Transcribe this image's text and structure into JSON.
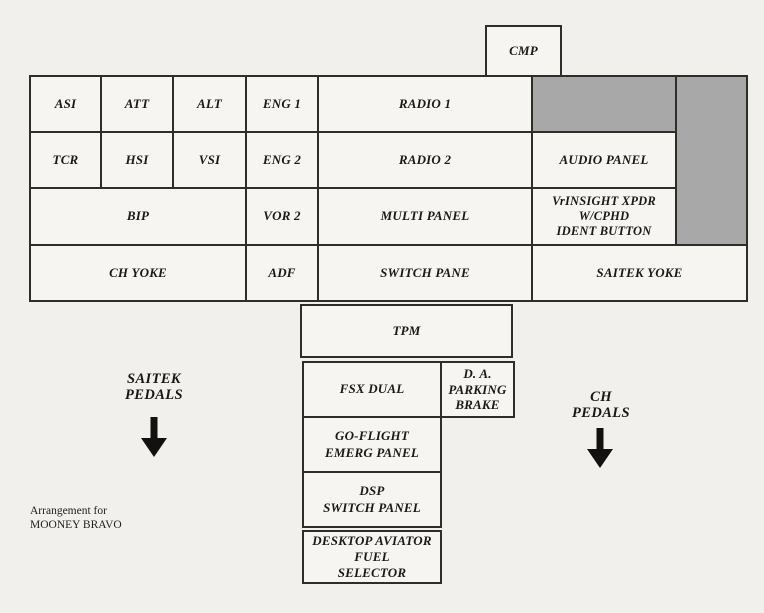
{
  "title_note": "Arrangement for\nMOONEY BRAVO",
  "colors": {
    "paper": "#f1f0ed",
    "cell_fill": "#f6f5f2",
    "gray_fill": "#a8a8a8",
    "border": "#2e2d2b"
  },
  "cmp_box": {
    "label": "CMP"
  },
  "panel_grid": {
    "row1": {
      "asi": "ASI",
      "att": "ATT",
      "alt": "ALT",
      "eng1": "ENG 1",
      "radio1": "RADIO 1"
    },
    "row2": {
      "tcr": "TCR",
      "hsi": "HSI",
      "vsi": "VSI",
      "eng2": "ENG 2",
      "radio2": "RADIO 2",
      "audio_panel": "AUDIO PANEL"
    },
    "row3": {
      "bip": "BIP",
      "vor2": "VOR 2",
      "multi_panel": "MULTI PANEL",
      "vrinsight_xpdr": "VrINSIGHT XPDR\nW/CPHD\nIDENT BUTTON"
    },
    "row4": {
      "ch_yoke": "CH YOKE",
      "adf": "ADF",
      "switch_pane": "SWITCH PANE",
      "saitek_yoke": "SAITEK YOKE"
    }
  },
  "bottom_stack": {
    "tpm": "TPM",
    "fsx_dual": "FSX DUAL",
    "da_parking_brake": "D. A.\nPARKING\nBRAKE",
    "go_flight_emerg_panel": "GO-FLIGHT\nEMERG PANEL",
    "dsp_switch_panel": "DSP\nSWITCH PANEL",
    "desktop_aviator_fuel_selector": "DESKTOP AVIATOR\nFUEL\nSELECTOR"
  },
  "annotations": {
    "saitek_pedals": "SAITEK\nPEDALS",
    "ch_pedals": "CH\nPEDALS"
  }
}
